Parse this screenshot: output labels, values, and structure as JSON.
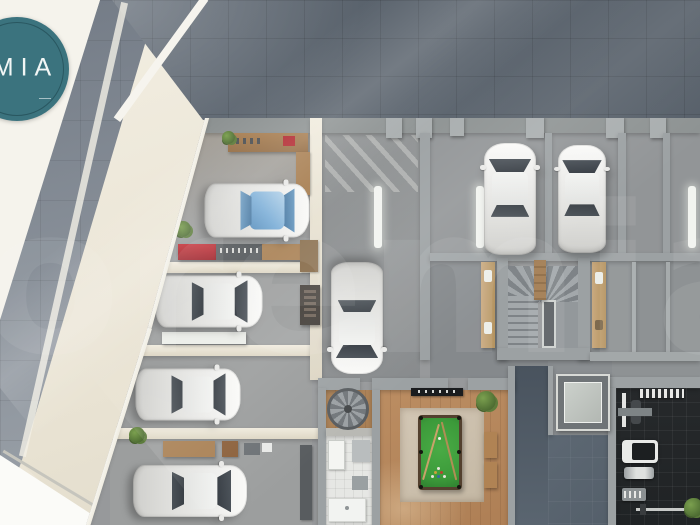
{
  "logo": {
    "text": "MIA",
    "background_color": "#3B737E",
    "ring_color": "#2F5E66",
    "text_color": "#F2F6F5"
  },
  "watermark": {
    "text": "oremia",
    "opacity": 0.07
  },
  "palette": {
    "exterior_tiles": "#5C656F",
    "sidewalk_band": "#89909A",
    "terrace_cream": "#E9E2D1",
    "floor_concrete": "#96999B",
    "wall_gray": "#9CA1A3",
    "wall_cream": "#EAE4D5",
    "ramp_dark": "#56616C",
    "gym_floor": "#26292B",
    "wood_floor": "#B5865C",
    "pool_felt": "#3C9A3A",
    "accent_red": "#B1252C",
    "plant_green": "#648740",
    "car_white": "#F0F0EE",
    "car_glass": "#3C4248",
    "car_glass_blue": "#7FB0D8"
  },
  "scene": {
    "description": "3D top-down architectural render of a residential basement parking floor",
    "rooms": [
      "garage-bay-1-workshop",
      "garage-bay-2",
      "garage-bay-3",
      "garage-bay-4",
      "driveway-lane",
      "guest-parking",
      "main-staircase",
      "spiral-staircase",
      "bathroom-laundry",
      "billiard-room",
      "car-ramp",
      "elevator",
      "gym"
    ],
    "cars": [
      {
        "id": "car-1",
        "variant": "blue-glass",
        "cx": 257,
        "cy": 210,
        "w": 54,
        "l": 105,
        "facing": "E"
      },
      {
        "id": "car-2",
        "variant": "white",
        "cx": 209,
        "cy": 301,
        "w": 52,
        "l": 107,
        "facing": "E"
      },
      {
        "id": "car-3",
        "variant": "white",
        "cx": 188,
        "cy": 394,
        "w": 52,
        "l": 105,
        "facing": "E"
      },
      {
        "id": "car-4",
        "variant": "white",
        "cx": 190,
        "cy": 491,
        "w": 52,
        "l": 114,
        "facing": "E"
      },
      {
        "id": "car-5",
        "variant": "white",
        "cx": 357,
        "cy": 318,
        "w": 52,
        "l": 112,
        "facing": "S"
      },
      {
        "id": "car-6",
        "variant": "white",
        "cx": 510,
        "cy": 199,
        "w": 52,
        "l": 112,
        "facing": "N"
      },
      {
        "id": "car-7",
        "variant": "white",
        "cx": 582,
        "cy": 199,
        "w": 48,
        "l": 108,
        "facing": "N"
      }
    ],
    "plants": [
      {
        "x": 222,
        "y": 131,
        "s": 13
      },
      {
        "x": 175,
        "y": 221,
        "s": 16
      },
      {
        "x": 129,
        "y": 427,
        "s": 16
      },
      {
        "x": 476,
        "y": 391,
        "s": 20
      },
      {
        "x": 684,
        "y": 498,
        "s": 19
      }
    ],
    "floor_lights": [
      {
        "x": 374,
        "y": 186
      },
      {
        "x": 476,
        "y": 186
      },
      {
        "x": 688,
        "y": 186
      }
    ]
  }
}
